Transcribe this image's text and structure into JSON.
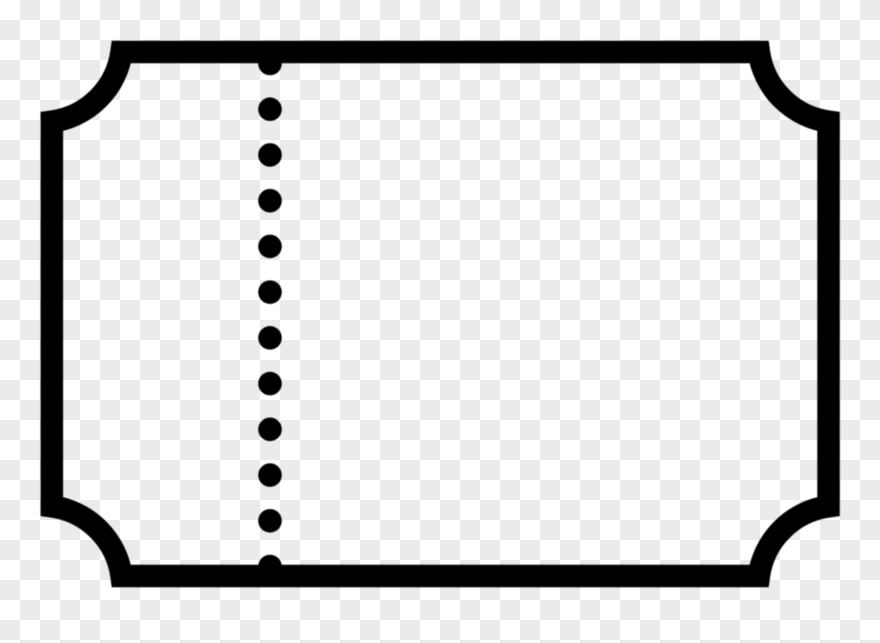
{
  "canvas": {
    "width": 880,
    "height": 643
  },
  "background": {
    "style": "transparency-checkerboard",
    "tile_size_px": 20,
    "color_light": "#ffffff",
    "color_dark": "#ebebeb"
  },
  "graphic": {
    "icon": "ticket-outline-icon",
    "description": "Blank admit-one style ticket stub outline with scooped (concave quarter-circle) corners and a vertical dotted perforation line near the left side",
    "stroke_color": "#000000",
    "stroke_width": 22.5,
    "outer_bounds": {
      "left": 40.6,
      "top": 40.7,
      "right": 839.8,
      "bottom": 587.3
    },
    "corner_radius": 81.7,
    "perforation": {
      "line_x": 270,
      "dot_radius": 11.8,
      "dot_count": 12,
      "first_dot_y": 63.5,
      "last_dot_y": 566.5
    }
  }
}
